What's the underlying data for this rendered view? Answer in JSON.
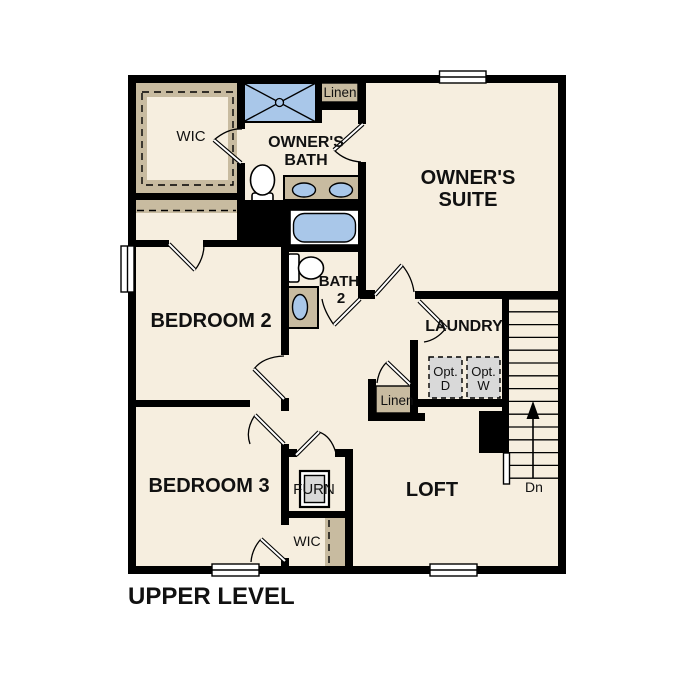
{
  "title": "UPPER LEVEL",
  "colors": {
    "floor": "#f6eedf",
    "cabinet_tan": "#c8bba0",
    "fixture_blue": "#a9c7e9",
    "appliance_gray": "#d9d9d9",
    "wall": "#000000"
  },
  "rooms": {
    "wic_upper": "WIC",
    "owners_bath": [
      "OWNER'S",
      "BATH"
    ],
    "linen_upper": "Linen",
    "owners_suite": [
      "OWNER'S",
      "SUITE"
    ],
    "bedroom2": "BEDROOM 2",
    "bath2": [
      "BATH",
      "2"
    ],
    "laundry": "LAUNDRY",
    "opt_dryer": [
      "Opt.",
      "D"
    ],
    "opt_washer": [
      "Opt.",
      "W"
    ],
    "linen_lower": "Linen",
    "bedroom3": "BEDROOM 3",
    "furnace": "FURN",
    "loft": "LOFT",
    "wic_lower": "WIC",
    "stairs_direction": "Dn"
  }
}
